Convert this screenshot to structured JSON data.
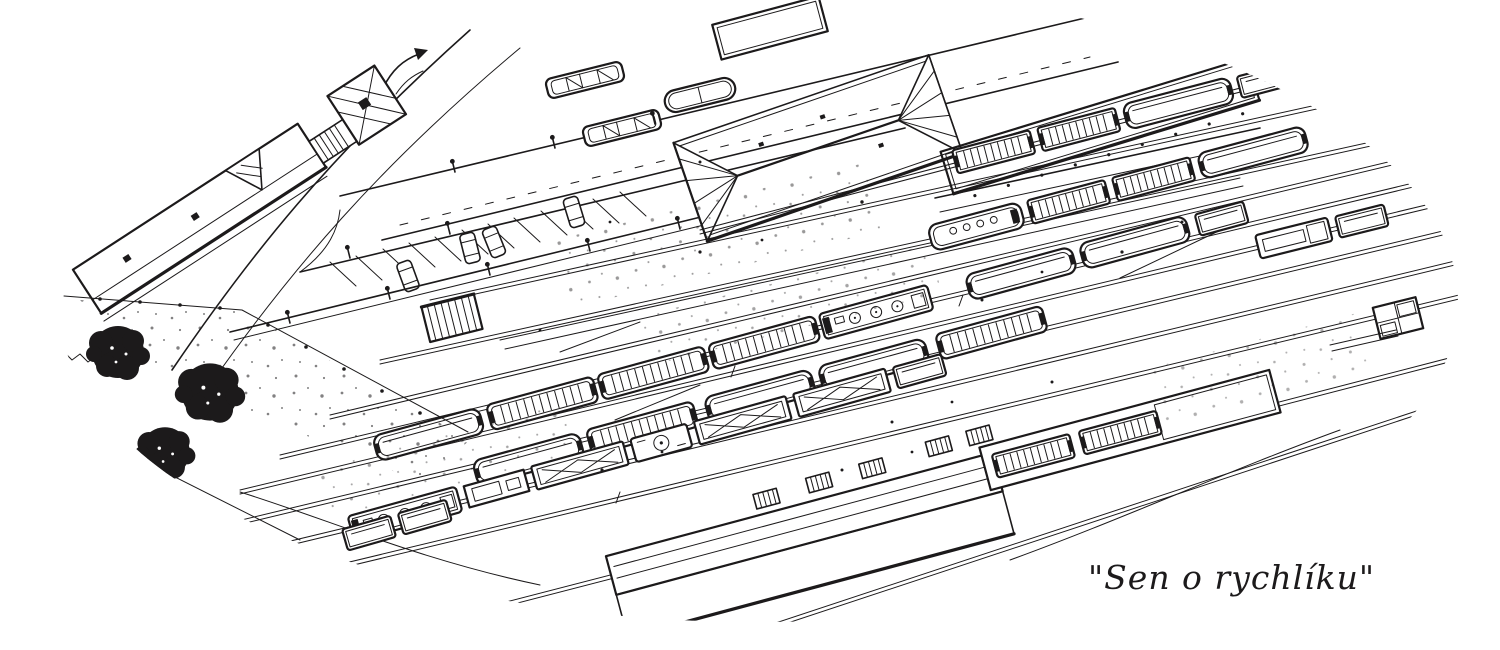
{
  "artwork": {
    "caption": "\"Sen o rychlíku\"",
    "subject": "aerial ink drawing of a railway station and freight yard",
    "vignette": "ellipse"
  },
  "colors": {
    "ink": "#1c1a1b",
    "paper": "#ffffff"
  }
}
